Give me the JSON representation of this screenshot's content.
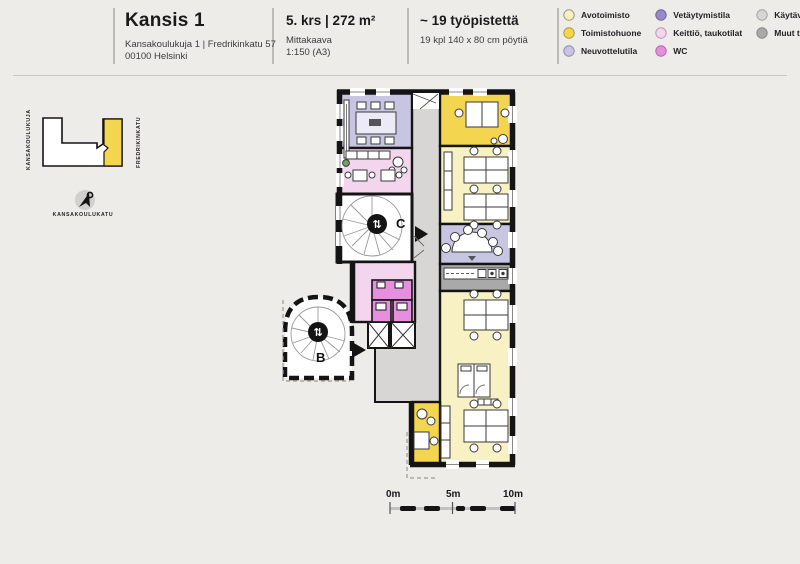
{
  "header": {
    "title": "Kansis 1",
    "address_line1": "Kansakoulukuja 1 | Fredrikinkatu 57",
    "address_line2": "00100 Helsinki",
    "floor_area": "5. krs | 272 m²",
    "scale_label": "Mittakaava",
    "scale_value": "1:150 (A3)",
    "workstations": "~ 19 työpistettä",
    "workstations_detail": "19 kpl 140 x 80 cm pöytiä"
  },
  "legend": {
    "items": [
      {
        "label": "Avotoimisto",
        "color": "#f8f1c3"
      },
      {
        "label": "Toimistohuone",
        "color": "#f3d54f"
      },
      {
        "label": "Neuvottelutila",
        "color": "#c8c5e2"
      },
      {
        "label": "Vetäytymistila",
        "color": "#958bc7"
      },
      {
        "label": "Keittiö, taukotilat",
        "color": "#f3d6ee"
      },
      {
        "label": "WC",
        "color": "#e78fdf"
      },
      {
        "label": "Käytävät",
        "color": "#d7d6d4"
      },
      {
        "label": "Muut tilat",
        "color": "#a9a9a9"
      }
    ]
  },
  "minimap": {
    "street_left": "KANSAKOULUKUJA",
    "street_right": "FREDRIKINKATU",
    "street_bottom": "KANSAKOULUKATU"
  },
  "floorplan": {
    "stair_b_label": "B",
    "stair_c_label": "C",
    "stair_icon_b": "⇅",
    "stair_icon_c": "⇅"
  },
  "scalebar": {
    "t0": "0m",
    "t5": "5m",
    "t10": "10m"
  }
}
